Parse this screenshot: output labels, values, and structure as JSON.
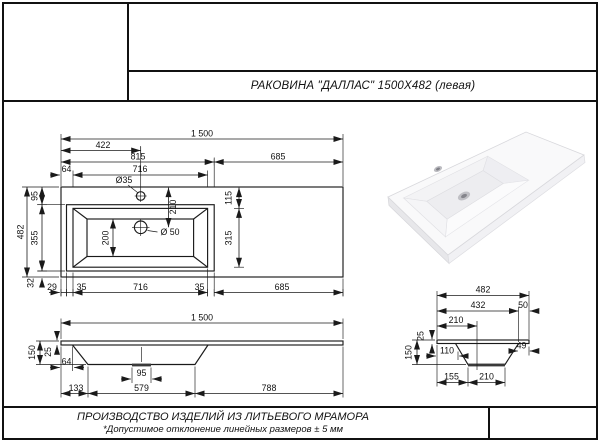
{
  "header": {
    "title": "РАКОВИНА \"ДАЛЛАС\" 1500X482 (левая)"
  },
  "footer": {
    "line1": "ПРОИЗВОДСТВО ИЗДЕЛИЙ ИЗ ЛИТЬЕВОГО МРАМОРА",
    "line2": "*Допустимое отклонение линейных размеров ±   5 мм"
  },
  "views": {
    "plan": {
      "total_width": "1 500",
      "faucet_offset": "422",
      "basin_zone": "815",
      "right_zone": "685",
      "edge_left": "64",
      "basin_width": "716",
      "faucet_dia": "Ø35",
      "depth_total": "482",
      "rim_top": "95",
      "basin_depth": "355",
      "rim_bottom": "32",
      "faucet_to_drain": "210",
      "floor_depth": "200",
      "drain_dia": "Ø 50",
      "right_rim": "115",
      "right_depth": "315",
      "b29": "29",
      "b35a": "35",
      "b716": "716",
      "b35b": "35",
      "b685": "685"
    },
    "front": {
      "total_width": "1 500",
      "height": "150",
      "slab_thickness": "25",
      "edge_left": "64",
      "drain_boss": "95",
      "b133": "133",
      "b579": "579",
      "b788": "788"
    },
    "side": {
      "depth_total": "482",
      "d432": "432",
      "d50": "50",
      "drain_offset": "210",
      "slab_thickness": "25",
      "height": "150",
      "d110": "110",
      "d49": "49",
      "b155": "155",
      "b210": "210"
    }
  }
}
